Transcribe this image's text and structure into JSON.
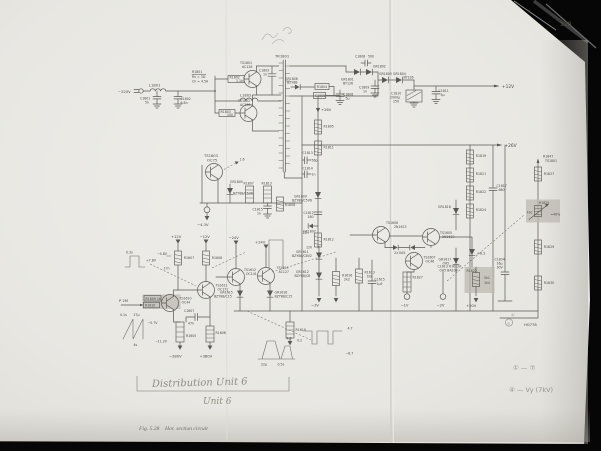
{
  "page": {
    "number": "128",
    "caption_fig": "Fig. 5.28",
    "caption_title": "Hor. section circuit"
  },
  "hand": {
    "unit_title": "Distribution Unit 6",
    "unit_sub": "Unit 6",
    "note1": "① — ⑦",
    "note2": "④ — Vy (7kV)",
    "mark": "4/",
    "circled": "6"
  },
  "t": {
    "mains": "~220V",
    "l1801": "L1801",
    "c1801": "C1801",
    "c1801v": "5n",
    "c1802": "C1802",
    "c1802v": "6.8n",
    "r1801": "R1801",
    "r1801a": "Rv = 3Ω",
    "r1801b": "Ch = 4.5A",
    "l1802": "L1802",
    "ts1801": "TS1801",
    "ts1801t": "AC128",
    "r1802": "R1802",
    "r1802v": "1.1k",
    "c1803": "C1803",
    "c1803v": "1n",
    "ts1802": "TS1802",
    "ts1802t": "AC128",
    "r1803": "R1803",
    "r1803v": "100",
    "tr1801": "TR1801",
    "c1808": "C1808",
    "c1808v": "500",
    "gr1801": "GR1801",
    "gr1801t": "BY126",
    "gr1802": "GR1802",
    "gr1803": "GR1803",
    "gr1804": "GR1804",
    "gr1804t": "BY126",
    "c1809": "C1809",
    "c1809v": "1n",
    "c1810": "C1810",
    "c1810v": "2000μ",
    "c1810w": "25V",
    "c1811": "C1811",
    "c1811v": "5μ",
    "out12": "+12V",
    "gr1806": "GR1806",
    "gr1806t": "BZY88",
    "r1804": "R1804",
    "c1805": "C1805",
    "c1806": "C1806",
    "c1806v": "5μ",
    "v26": "+26V",
    "r1805": "R1805",
    "r1811": "R1811",
    "gr1809": "GR1809",
    "gr1809t": "BZY88/C5V6",
    "c1812": "C1812",
    "c1812v": "180",
    "gr1807": "GR1807",
    "r1812": "R1812",
    "c1813": "C1813",
    "c1813v": "56p",
    "c1814": "C1814",
    "c1814v": "1n",
    "n12": "12n",
    "v12s": "12V",
    "ts1803": "TS1803",
    "ts1803t": "OC75",
    "p16": "1.6",
    "gr1805": "GR1805",
    "gr1805t": "BZY88/C5V6",
    "r1807": "R1807",
    "r1813": "R1813",
    "c1815": "C1815",
    "c1815v": "1n",
    "r1808": "R1808",
    "va": "−4.3V",
    "out26": "+26V",
    "r1819": "R1819",
    "r1821": "R1821",
    "r1822": "R1822",
    "r1824": "R1824",
    "c1817": "C1817",
    "c1817v": "680",
    "gr1818": "GR1818",
    "gr1617": "GR1617",
    "gr1617t": "OA5",
    "r1847": "R1847",
    "r1847t": "TS1801",
    "r1827": "R1827",
    "r1825": "R1825",
    "foc": "Foc",
    "pct40": "≈40%",
    "r1829": "R1829",
    "r1830": "R1830",
    "c1834": "C1834",
    "c1834v": "16μ",
    "c1834w": "30V",
    "hq": "HG778",
    "sup1": "+12V",
    "sup2": "−12V",
    "sup3": "−24V",
    "sup4": "+24V",
    "vm48": "−4.8V",
    "r1607": "R1607",
    "r1608": "R1608",
    "r1609": "R1609  1k",
    "r1610": "R1610",
    "p2m": "P 2M",
    "ts1610": "TS1610",
    "ts1610t": "OC44",
    "ts1611": "TS1611",
    "ts1611t": "OC171",
    "ts1612": "TS1612",
    "ts1612t": "OC141",
    "ts1613": "TS1613",
    "ts1613t": "AC127",
    "c1607": "C1607",
    "c1607v": "47n",
    "r1605": "R1605",
    "r1606": "R1606",
    "r1619": "R1619",
    "gr1615": "GR1615",
    "gr1615t": "BZY88/C15",
    "gr1616": "GR1616",
    "gr1616t": "BZY88/C15",
    "vm280": "−280V",
    "vp380": "+380V",
    "w1t": "0.3s",
    "w1a": "+7.8V",
    "w1b": "17n",
    "w2t": "0.1s",
    "w2u": "27μ",
    "w2a": "−5.7V",
    "w2b": "4s",
    "w2c": "−11.2V",
    "w3a": "22μ",
    "w3b": "0.5s",
    "w3c": "4.8",
    "w4a": "4.7",
    "w4b": "−6.7",
    "w4c": "0.2",
    "ts1606": "TS1606",
    "ts1606t": "2N1613",
    "ts1605": "TS1605",
    "ts1605t": "2N1613",
    "oa5": "2×OA5",
    "ts1607": "TS1607",
    "ts1607t": "OC46",
    "dense1": "C1613  R1612A",
    "dense2": "OA5  BA208",
    "gr1611": "GR1611",
    "gr1611t": "BZY88/C8V2",
    "gr1612": "GR1612",
    "gr1612t": "BZY88/C8",
    "r1616": "R1616",
    "r1616v": "2k2",
    "r1613": "R1613",
    "r1613v": "1k8",
    "c1615": "C1615",
    "c1615v": "1μ5",
    "r1627": "R1627",
    "vm1": "−1V",
    "vm2": "−2V",
    "vm3": "−3V",
    "zp62": "+6.2",
    "r1622": "R1622",
    "r1622a": "5k1",
    "r1622b": "1k4",
    "vp20": "+20V"
  }
}
